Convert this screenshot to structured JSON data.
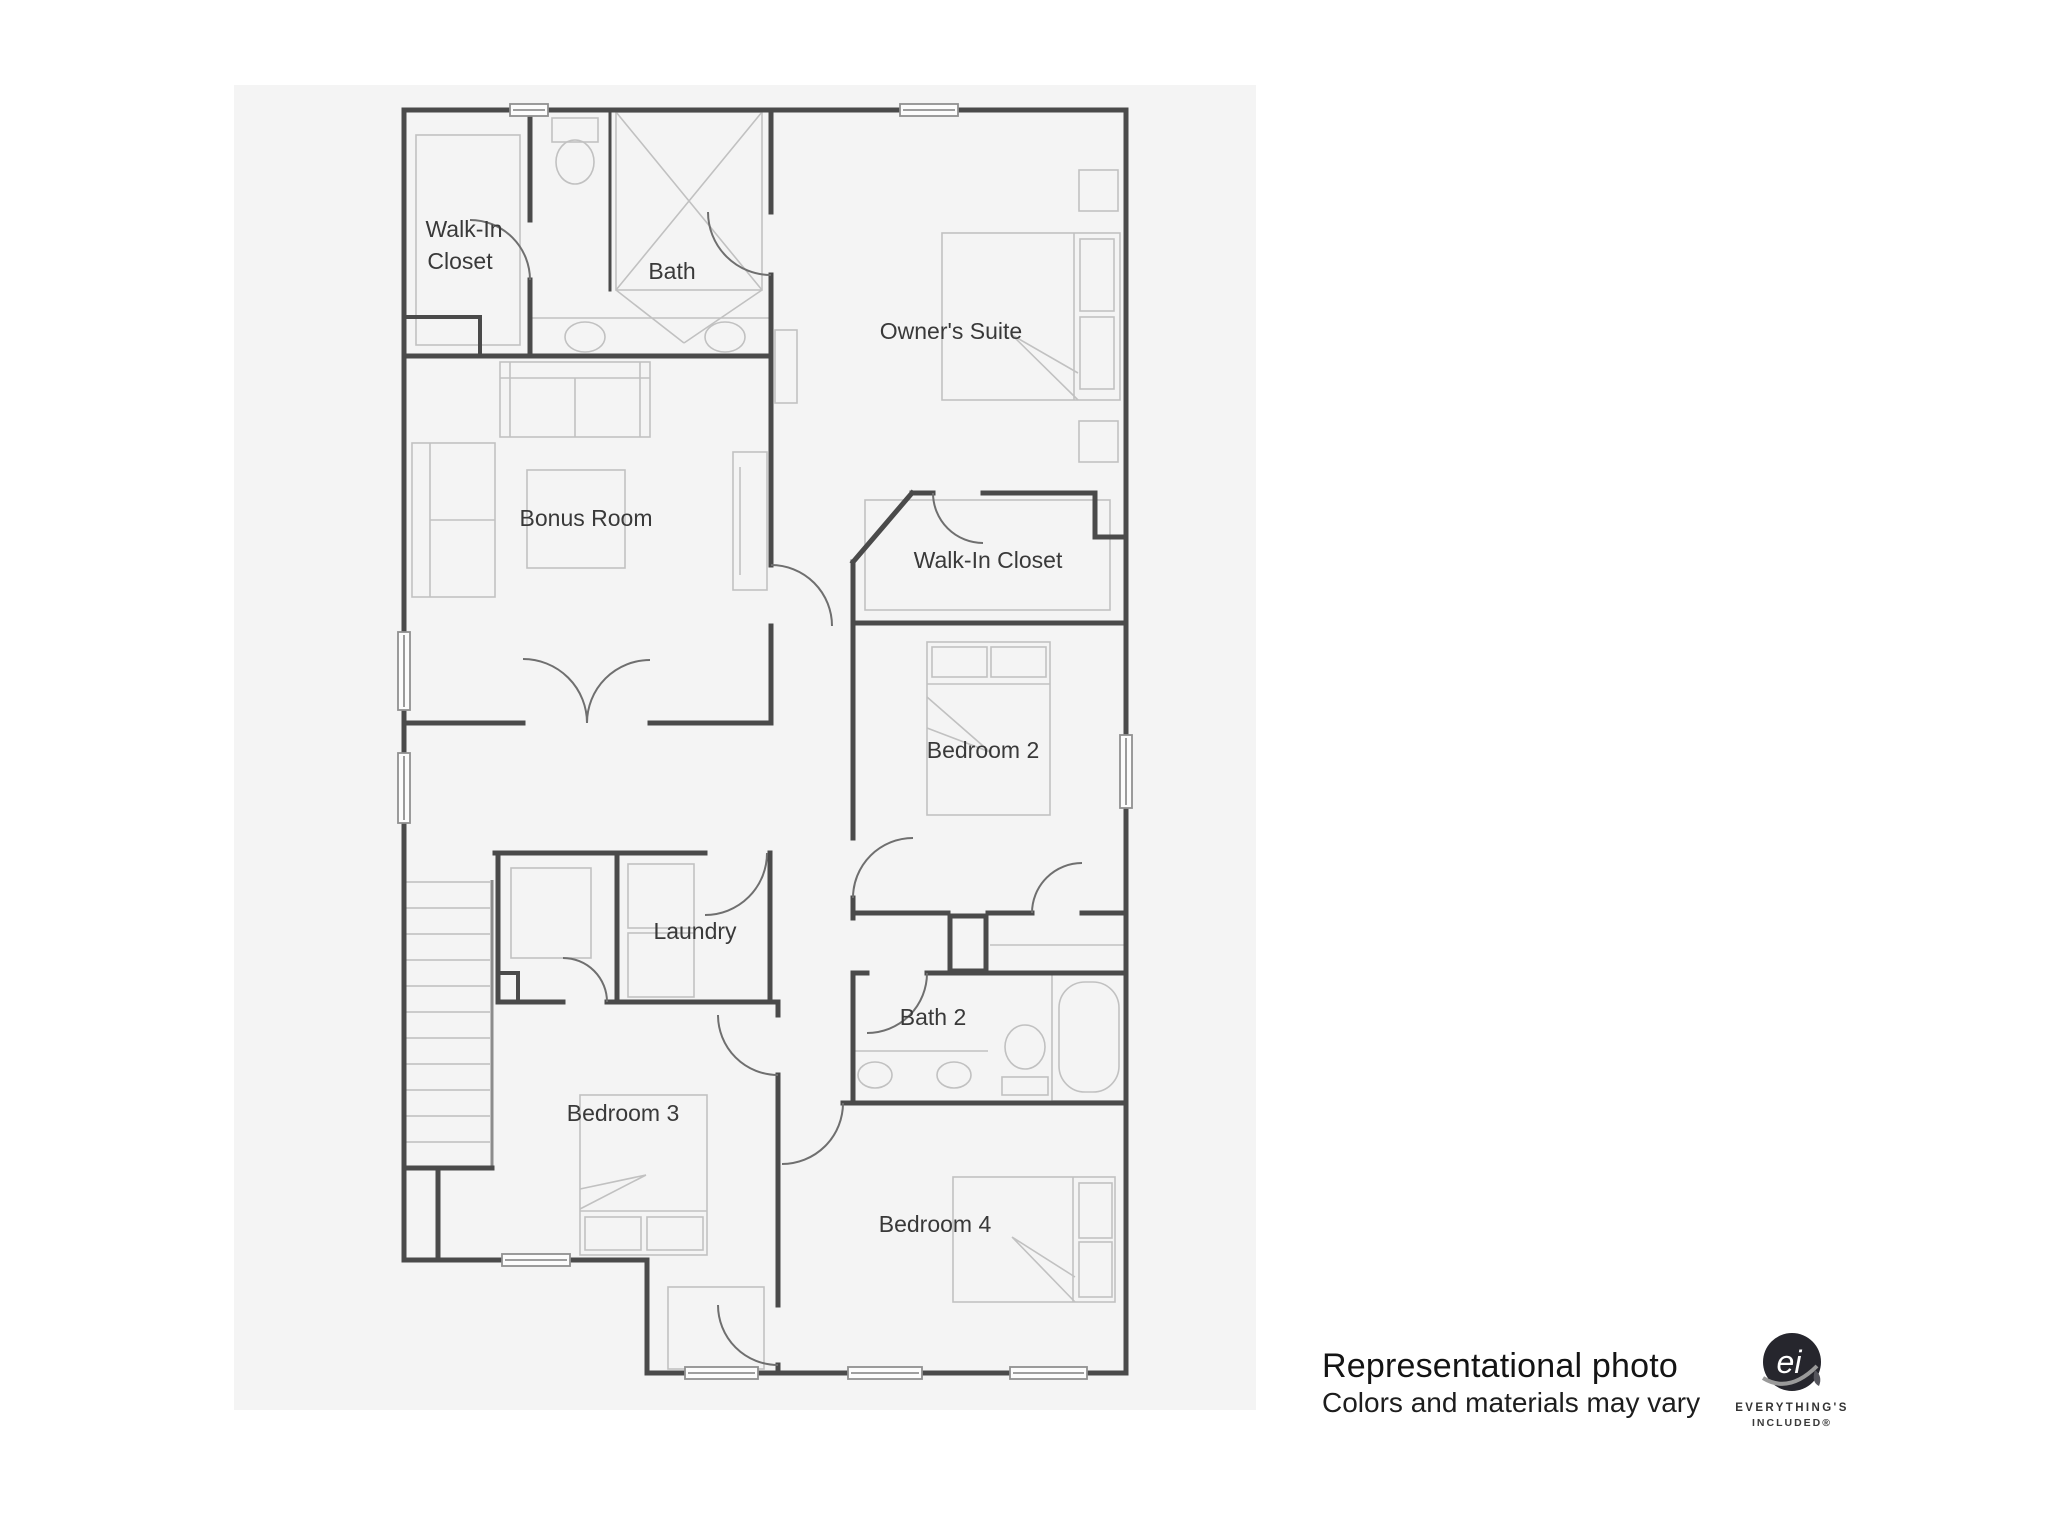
{
  "floor_plan": {
    "background_color": "#f4f4f4",
    "wall_color": "#4a4a4a",
    "furniture_color": "#c1c1c1",
    "door_color": "#6f6f6f",
    "label_color": "#393939",
    "rooms": {
      "walk_in_closet_1": {
        "label_line1": "Walk-In",
        "label_line2": "Closet"
      },
      "bath": {
        "label": "Bath"
      },
      "owners_suite": {
        "label": "Owner's Suite"
      },
      "bonus_room": {
        "label": "Bonus Room"
      },
      "walk_in_closet_2": {
        "label": "Walk-In Closet"
      },
      "bedroom_2": {
        "label": "Bedroom 2"
      },
      "laundry": {
        "label": "Laundry"
      },
      "bath_2": {
        "label": "Bath 2"
      },
      "bedroom_3": {
        "label": "Bedroom 3"
      },
      "bedroom_4": {
        "label": "Bedroom 4"
      }
    }
  },
  "footer": {
    "disclaimer_line1": "Representational photo",
    "disclaimer_line2": "Colors and materials may vary",
    "logo": {
      "monogram": "ei",
      "brand_line1": "EVERYTHING'S",
      "brand_line2": "INCLUDED®"
    }
  }
}
